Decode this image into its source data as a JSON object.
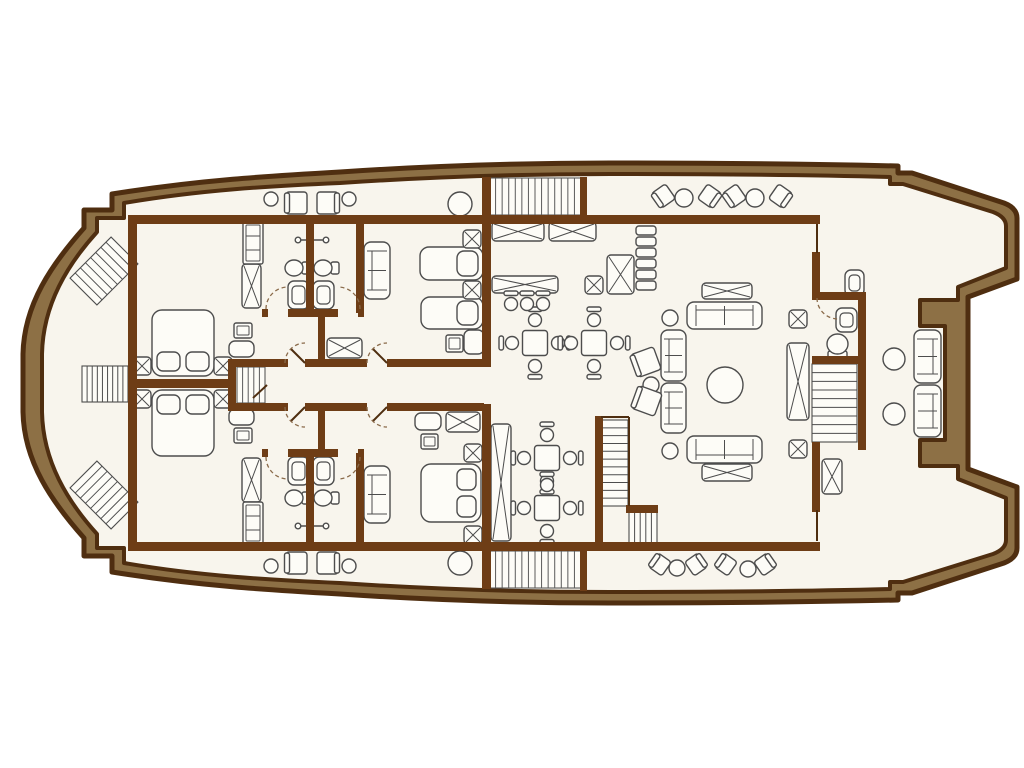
{
  "canvas": {
    "w": 1024,
    "h": 768
  },
  "colors": {
    "background": "#ffffff",
    "hull_band": "#8d7045",
    "outline": "#4f2e10",
    "wall": "#6e3d16",
    "deck": "#f8f5ed",
    "furniture_fill": "#fdfcf7",
    "furniture_line": "#4d4d4d",
    "hatch_line": "#5a5a5a",
    "door_arc": "#8a6a4a"
  },
  "hull": {
    "outer": "M 84,228 L 84,210 L 112,210 L 112,194 C 200,180 270,176 340,172 C 430,166 520,163 610,163 C 710,163 810,164 898,166 L 898,173 L 912,173 L 1004,203 Q 1017,208 1017,218 L 1017,279 L 968,297 L 968,469 L 1017,487 L 1017,548 Q 1017,558 1004,563 L 912,593 L 898,593 L 898,600 C 810,602 710,603 610,603 C 520,603 430,600 340,594 C 270,590 200,586 112,572 L 112,556 L 84,556 L 84,538 C 52,502 24,462 23,412 L 23,354 C 24,304 52,264 84,228 Z",
    "deck": "M 97,232 L 97,218 L 124,218 L 124,203 C 200,190 270,186 340,183 C 430,177 520,174 610,174 C 710,174 810,175 890,177 L 890,184 L 903,184 L 993,212 Q 1006,217 1006,226 L 1006,268 L 958,287 L 958,300 L 920,300 L 920,326 L 945,326 L 945,440 L 920,440 L 920,466 L 958,466 L 958,479 L 1006,498 L 1006,540 Q 1006,549 993,554 L 903,582 L 890,582 L 890,589 C 810,591 710,592 610,592 C 520,592 430,589 340,583 C 270,580 200,576 124,563 L 124,548 L 97,548 L 97,534 C 68,502 43,462 42,412 L 42,354 C 43,304 68,264 97,232 Z"
  },
  "walls": [
    [
      128,
      215,
      692,
      9
    ],
    [
      128,
      542,
      692,
      9
    ],
    [
      128,
      215,
      9,
      336
    ],
    [
      128,
      379,
      100,
      9
    ],
    [
      228,
      359,
      8,
      52
    ],
    [
      228,
      359,
      60,
      8
    ],
    [
      305,
      359,
      62,
      8
    ],
    [
      387,
      359,
      97,
      8
    ],
    [
      228,
      403,
      60,
      8
    ],
    [
      305,
      403,
      62,
      8
    ],
    [
      387,
      403,
      97,
      8
    ],
    [
      318,
      313,
      7,
      50
    ],
    [
      318,
      407,
      7,
      46
    ],
    [
      482,
      177,
      9,
      190
    ],
    [
      482,
      404,
      9,
      185
    ],
    [
      580,
      177,
      7,
      40
    ],
    [
      580,
      551,
      7,
      40
    ],
    [
      262,
      309,
      6,
      8
    ],
    [
      288,
      309,
      50,
      8
    ],
    [
      358,
      309,
      6,
      8
    ],
    [
      262,
      449,
      6,
      8
    ],
    [
      288,
      449,
      50,
      8
    ],
    [
      358,
      449,
      6,
      8
    ],
    [
      306,
      215,
      8,
      98
    ],
    [
      356,
      215,
      8,
      98
    ],
    [
      306,
      453,
      8,
      94
    ],
    [
      356,
      453,
      8,
      94
    ],
    [
      595,
      416,
      8,
      130
    ],
    [
      626,
      505,
      32,
      8
    ],
    [
      812,
      252,
      8,
      46
    ],
    [
      812,
      292,
      54,
      8
    ],
    [
      858,
      292,
      8,
      74
    ],
    [
      812,
      356,
      50,
      8
    ],
    [
      858,
      360,
      8,
      90
    ],
    [
      812,
      442,
      8,
      70
    ]
  ],
  "thin_lines": [
    [
      817,
      224,
      817,
      253
    ],
    [
      817,
      510,
      817,
      541
    ],
    [
      601,
      417,
      629,
      417
    ],
    [
      629,
      417,
      629,
      506
    ],
    [
      267,
      385,
      253,
      398
    ],
    [
      305,
      363,
      291,
      349
    ],
    [
      305,
      407,
      291,
      421
    ],
    [
      387,
      363,
      373,
      349
    ],
    [
      387,
      407,
      373,
      421
    ]
  ],
  "door_arcs": [
    "M 285,363 A 20,20 0 0 1 305,343",
    "M 285,407 A 20,20 0 0 0 305,427",
    "M 367,363 A 20,20 0 0 1 387,343",
    "M 367,407 A 20,20 0 0 0 387,427",
    "M 266,309 A 22,22 0 0 1 288,287",
    "M 360,309 A 22,22 0 0 0 338,287",
    "M 266,457 A 22,22 0 0 0 288,479",
    "M 360,457 A 22,22 0 0 1 338,479",
    "M 817,298 A 21,21 0 0 0 838,319"
  ],
  "items": [
    {
      "t": "stairs",
      "x": 82,
      "y": 366,
      "w": 46,
      "h": 36,
      "n": 8,
      "d": "h"
    },
    {
      "t": "stairs",
      "x": 75,
      "y": 252,
      "w": 58,
      "h": 38,
      "n": 7,
      "d": "h",
      "r": -45
    },
    {
      "t": "stairs",
      "x": 75,
      "y": 476,
      "w": 58,
      "h": 38,
      "n": 7,
      "d": "h",
      "r": 45
    },
    {
      "t": "hatch",
      "x": 237,
      "y": 367,
      "w": 28,
      "h": 36,
      "n": 4,
      "d": "h"
    },
    {
      "t": "hatch",
      "x": 489,
      "y": 178,
      "w": 92,
      "h": 37,
      "n": 13,
      "d": "h"
    },
    {
      "t": "hatch",
      "x": 489,
      "y": 551,
      "w": 92,
      "h": 37,
      "n": 13,
      "d": "h"
    },
    {
      "t": "stairs",
      "x": 601,
      "y": 420,
      "w": 27,
      "h": 86,
      "n": 10,
      "d": "v"
    },
    {
      "t": "stairs",
      "x": 629,
      "y": 512,
      "w": 28,
      "h": 34,
      "n": 4,
      "d": "h"
    },
    {
      "t": "stairs",
      "x": 812,
      "y": 364,
      "w": 45,
      "h": 78,
      "n": 8,
      "d": "v"
    },
    {
      "t": "bedd",
      "x": 152,
      "y": 310,
      "w": 62,
      "h": 66,
      "head": "s"
    },
    {
      "t": "bedd",
      "x": 152,
      "y": 390,
      "w": 62,
      "h": 66,
      "head": "n"
    },
    {
      "t": "bedd",
      "x": 421,
      "y": 464,
      "w": 60,
      "h": 58,
      "head": "e"
    },
    {
      "t": "beds",
      "x": 420,
      "y": 247,
      "w": 63,
      "h": 33
    },
    {
      "t": "beds",
      "x": 421,
      "y": 297,
      "w": 62,
      "h": 32
    },
    {
      "t": "xs",
      "x": 133,
      "y": 357,
      "w": 18,
      "h": 18
    },
    {
      "t": "xs",
      "x": 214,
      "y": 357,
      "w": 18,
      "h": 18
    },
    {
      "t": "xs",
      "x": 133,
      "y": 390,
      "w": 18,
      "h": 18
    },
    {
      "t": "xs",
      "x": 214,
      "y": 390,
      "w": 18,
      "h": 18
    },
    {
      "t": "xs",
      "x": 463,
      "y": 230,
      "w": 18,
      "h": 18
    },
    {
      "t": "xs",
      "x": 463,
      "y": 281,
      "w": 18,
      "h": 18
    },
    {
      "t": "xs",
      "x": 464,
      "y": 444,
      "w": 18,
      "h": 18
    },
    {
      "t": "xs",
      "x": 464,
      "y": 526,
      "w": 18,
      "h": 18
    },
    {
      "t": "xs",
      "x": 585,
      "y": 276,
      "w": 18,
      "h": 18
    },
    {
      "t": "xs",
      "x": 789,
      "y": 310,
      "w": 18,
      "h": 18
    },
    {
      "t": "xs",
      "x": 789,
      "y": 440,
      "w": 18,
      "h": 18
    },
    {
      "t": "xr",
      "x": 242,
      "y": 264,
      "w": 19,
      "h": 44
    },
    {
      "t": "xr",
      "x": 242,
      "y": 458,
      "w": 19,
      "h": 44
    },
    {
      "t": "xr",
      "x": 327,
      "y": 338,
      "w": 35,
      "h": 20
    },
    {
      "t": "xr",
      "x": 446,
      "y": 412,
      "w": 34,
      "h": 20
    },
    {
      "t": "xr",
      "x": 492,
      "y": 222,
      "w": 52,
      "h": 19
    },
    {
      "t": "xr",
      "x": 549,
      "y": 222,
      "w": 47,
      "h": 19
    },
    {
      "t": "xr",
      "x": 492,
      "y": 276,
      "w": 66,
      "h": 17
    },
    {
      "t": "xr",
      "x": 607,
      "y": 255,
      "w": 27,
      "h": 39
    },
    {
      "t": "xr",
      "x": 702,
      "y": 283,
      "w": 50,
      "h": 16
    },
    {
      "t": "xr",
      "x": 702,
      "y": 464,
      "w": 50,
      "h": 17
    },
    {
      "t": "xr",
      "x": 787,
      "y": 343,
      "w": 22,
      "h": 77
    },
    {
      "t": "xr",
      "x": 822,
      "y": 459,
      "w": 20,
      "h": 35
    },
    {
      "t": "xr",
      "x": 491,
      "y": 424,
      "w": 20,
      "h": 117
    },
    {
      "t": "cab",
      "x": 243,
      "y": 222,
      "w": 20,
      "h": 42
    },
    {
      "t": "cab",
      "x": 243,
      "y": 502,
      "w": 20,
      "h": 42
    },
    {
      "t": "stack",
      "x": 636,
      "y": 226,
      "w": 20,
      "h": 64,
      "n": 6
    },
    {
      "t": "sofa",
      "x": 364,
      "y": 242,
      "w": 26,
      "h": 57,
      "b": "w"
    },
    {
      "t": "sofa",
      "x": 364,
      "y": 466,
      "w": 26,
      "h": 57,
      "b": "w"
    },
    {
      "t": "sofa",
      "x": 687,
      "y": 302,
      "w": 75,
      "h": 27,
      "b": "n"
    },
    {
      "t": "sofa",
      "x": 687,
      "y": 436,
      "w": 75,
      "h": 27,
      "b": "s"
    },
    {
      "t": "sofa",
      "x": 661,
      "y": 330,
      "w": 25,
      "h": 51,
      "b": "w"
    },
    {
      "t": "sofa",
      "x": 661,
      "y": 383,
      "w": 25,
      "h": 50,
      "b": "w"
    },
    {
      "t": "sofa",
      "x": 914,
      "y": 330,
      "w": 27,
      "h": 53,
      "b": "e"
    },
    {
      "t": "sofa",
      "x": 914,
      "y": 385,
      "w": 27,
      "h": 52,
      "b": "e"
    },
    {
      "t": "circ",
      "cx": 271,
      "cy": 199,
      "rr": 7
    },
    {
      "t": "circ",
      "cx": 349,
      "cy": 199,
      "rr": 7
    },
    {
      "t": "circ",
      "cx": 460,
      "cy": 204,
      "rr": 12
    },
    {
      "t": "circ",
      "cx": 271,
      "cy": 566,
      "rr": 7
    },
    {
      "t": "circ",
      "cx": 349,
      "cy": 566,
      "rr": 7
    },
    {
      "t": "circ",
      "cx": 460,
      "cy": 563,
      "rr": 12
    },
    {
      "t": "circ",
      "cx": 684,
      "cy": 198,
      "rr": 9
    },
    {
      "t": "circ",
      "cx": 755,
      "cy": 198,
      "rr": 9
    },
    {
      "t": "circ",
      "cx": 677,
      "cy": 568,
      "rr": 8
    },
    {
      "t": "circ",
      "cx": 748,
      "cy": 569,
      "rr": 8
    },
    {
      "t": "circ",
      "cx": 725,
      "cy": 385,
      "rr": 18
    },
    {
      "t": "circ",
      "cx": 670,
      "cy": 318,
      "rr": 8
    },
    {
      "t": "circ",
      "cx": 670,
      "cy": 451,
      "rr": 8
    },
    {
      "t": "circ",
      "cx": 651,
      "cy": 385,
      "rr": 8
    },
    {
      "t": "circ",
      "cx": 894,
      "cy": 359,
      "rr": 11
    },
    {
      "t": "circ",
      "cx": 894,
      "cy": 414,
      "rr": 11
    },
    {
      "t": "chair",
      "x": 286,
      "y": 192,
      "w": 21,
      "h": 22,
      "b": "w"
    },
    {
      "t": "chair",
      "x": 317,
      "y": 192,
      "w": 21,
      "h": 22,
      "b": "e"
    },
    {
      "t": "chair",
      "x": 286,
      "y": 552,
      "w": 21,
      "h": 22,
      "b": "w"
    },
    {
      "t": "chair",
      "x": 317,
      "y": 552,
      "w": 21,
      "h": 22,
      "b": "e"
    },
    {
      "t": "chair",
      "x": 655,
      "y": 187,
      "w": 17,
      "h": 18,
      "b": "w",
      "r": -35
    },
    {
      "t": "chair",
      "x": 701,
      "y": 187,
      "w": 17,
      "h": 18,
      "b": "e",
      "r": 35
    },
    {
      "t": "chair",
      "x": 726,
      "y": 187,
      "w": 17,
      "h": 18,
      "b": "w",
      "r": -35
    },
    {
      "t": "chair",
      "x": 772,
      "y": 187,
      "w": 17,
      "h": 18,
      "b": "e",
      "r": 35
    },
    {
      "t": "chair",
      "x": 652,
      "y": 556,
      "w": 16,
      "h": 17,
      "b": "w",
      "r": 35
    },
    {
      "t": "chair",
      "x": 688,
      "y": 556,
      "w": 16,
      "h": 17,
      "b": "e",
      "r": -35
    },
    {
      "t": "chair",
      "x": 718,
      "y": 556,
      "w": 16,
      "h": 17,
      "b": "w",
      "r": 35
    },
    {
      "t": "chair",
      "x": 757,
      "y": 556,
      "w": 16,
      "h": 17,
      "b": "e",
      "r": -35
    },
    {
      "t": "chair",
      "x": 634,
      "y": 350,
      "w": 24,
      "h": 24,
      "b": "w",
      "r": -20
    },
    {
      "t": "chair",
      "x": 635,
      "y": 389,
      "w": 24,
      "h": 24,
      "b": "w",
      "r": 20
    },
    {
      "t": "din",
      "cx": 535,
      "cy": 343
    },
    {
      "t": "din",
      "cx": 594,
      "cy": 343
    },
    {
      "t": "din",
      "cx": 547,
      "cy": 458
    },
    {
      "t": "din",
      "cx": 547,
      "cy": 508
    },
    {
      "t": "bar",
      "cx": 511,
      "cy": 304
    },
    {
      "t": "bar",
      "cx": 527,
      "cy": 304
    },
    {
      "t": "bar",
      "cx": 543,
      "cy": 304
    },
    {
      "t": "unit",
      "x": 288,
      "y": 281,
      "w": 21,
      "h": 28
    },
    {
      "t": "unit",
      "x": 313,
      "y": 281,
      "w": 21,
      "h": 28
    },
    {
      "t": "unit",
      "x": 288,
      "y": 457,
      "w": 21,
      "h": 28
    },
    {
      "t": "unit",
      "x": 313,
      "y": 457,
      "w": 21,
      "h": 28
    },
    {
      "t": "unit",
      "x": 836,
      "y": 308,
      "w": 21,
      "h": 24
    },
    {
      "t": "unit",
      "x": 845,
      "y": 270,
      "w": 19,
      "h": 26
    },
    {
      "t": "wc",
      "x": 827,
      "y": 334,
      "w": 21,
      "h": 26
    },
    {
      "t": "sink",
      "x": 285,
      "y": 259,
      "w": 26,
      "h": 18
    },
    {
      "t": "sink",
      "x": 314,
      "y": 259,
      "w": 26,
      "h": 18
    },
    {
      "t": "sink",
      "x": 285,
      "y": 489,
      "w": 26,
      "h": 18
    },
    {
      "t": "sink",
      "x": 314,
      "y": 489,
      "w": 26,
      "h": 18
    },
    {
      "t": "rail",
      "x1": 298,
      "y1": 240,
      "x2": 326,
      "y2": 240
    },
    {
      "t": "rail",
      "x1": 298,
      "y1": 526,
      "x2": 326,
      "y2": 526
    },
    {
      "t": "stool",
      "x": 234,
      "y": 323,
      "w": 18,
      "h": 15
    },
    {
      "t": "stool",
      "x": 234,
      "y": 428,
      "w": 18,
      "h": 15
    },
    {
      "t": "stool",
      "x": 446,
      "y": 335,
      "w": 17,
      "h": 17
    },
    {
      "t": "stool",
      "x": 421,
      "y": 434,
      "w": 17,
      "h": 15
    },
    {
      "t": "pouf",
      "x": 229,
      "y": 341,
      "w": 25,
      "h": 16
    },
    {
      "t": "pouf",
      "x": 229,
      "y": 409,
      "w": 25,
      "h": 16
    },
    {
      "t": "pouf",
      "x": 464,
      "y": 330,
      "w": 20,
      "h": 24
    },
    {
      "t": "pouf",
      "x": 415,
      "y": 413,
      "w": 26,
      "h": 17
    }
  ]
}
